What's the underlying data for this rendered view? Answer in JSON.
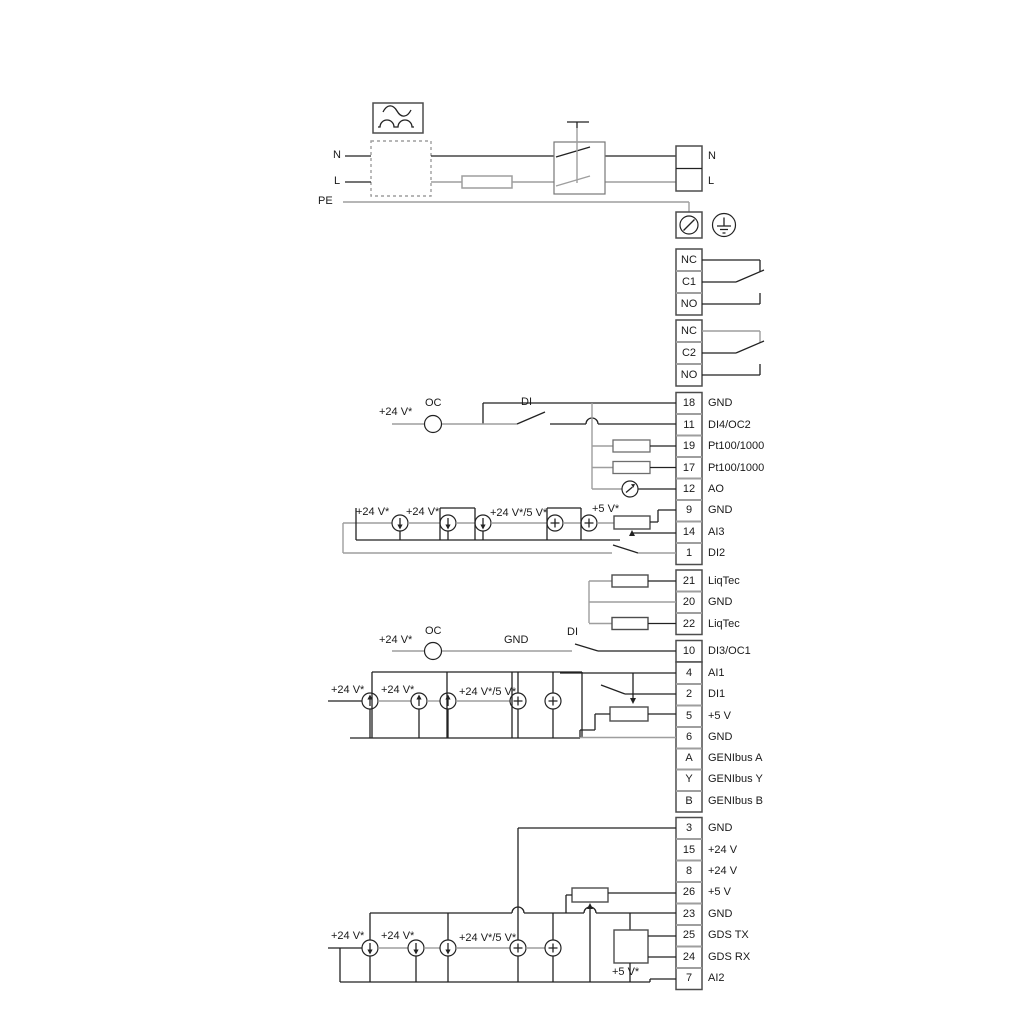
{
  "diagram_title": "pump-drive-wiring-diagram",
  "colors": {
    "wire_black": "#222222",
    "wire_gray": "#9e9e9e",
    "box_border": "#4d4d4d",
    "text": "#1a1a1a",
    "background": "#ffffff"
  },
  "power": {
    "left": {
      "n": "N",
      "l": "L",
      "pe": "PE"
    },
    "right": {
      "n": "N",
      "l": "L"
    }
  },
  "relays": [
    {
      "nc": "NC",
      "c": "C1",
      "no": "NO"
    },
    {
      "nc": "NC",
      "c": "C2",
      "no": "NO"
    }
  ],
  "annotations": {
    "oc_top": "OC",
    "di_top": "DI",
    "v24_top": "+24 V*",
    "ai3_v24a": "+24 V*",
    "ai3_v24b": "+24 V*",
    "ai3_v245": "+24 V*/5 V*",
    "ai3_v5": "+5 V*",
    "r10_v24": "+24 V*",
    "r10_oc": "OC",
    "r10_gnd": "GND",
    "r10_di": "DI",
    "ai1_v24a": "+24 V*",
    "ai1_v24b": "+24 V*",
    "ai1_v245": "+24 V*/5 V*",
    "ai2_v24a": "+24 V*",
    "ai2_v24b": "+24 V*",
    "ai2_v245": "+24 V*/5 V*",
    "gds_v5": "+5 V*"
  },
  "terminals": {
    "groupA": [
      {
        "id": "18",
        "label": "GND"
      },
      {
        "id": "11",
        "label": "DI4/OC2"
      },
      {
        "id": "19",
        "label": "Pt100/1000"
      },
      {
        "id": "17",
        "label": "Pt100/1000"
      },
      {
        "id": "12",
        "label": "AO"
      },
      {
        "id": "9",
        "label": "GND"
      },
      {
        "id": "14",
        "label": "AI3"
      },
      {
        "id": "1",
        "label": "DI2"
      }
    ],
    "groupB": [
      {
        "id": "21",
        "label": "LiqTec"
      },
      {
        "id": "20",
        "label": "GND"
      },
      {
        "id": "22",
        "label": "LiqTec"
      }
    ],
    "groupC": [
      {
        "id": "10",
        "label": "DI3/OC1"
      }
    ],
    "groupD": [
      {
        "id": "4",
        "label": "AI1"
      },
      {
        "id": "2",
        "label": "DI1"
      },
      {
        "id": "5",
        "label": "+5 V"
      },
      {
        "id": "6",
        "label": "GND"
      },
      {
        "id": "A",
        "label": "GENIbus A"
      },
      {
        "id": "Y",
        "label": "GENIbus Y"
      },
      {
        "id": "B",
        "label": "GENIbus B"
      }
    ],
    "groupE": [
      {
        "id": "3",
        "label": "GND"
      },
      {
        "id": "15",
        "label": "+24 V"
      },
      {
        "id": "8",
        "label": "+24 V"
      },
      {
        "id": "26",
        "label": "+5 V"
      },
      {
        "id": "23",
        "label": "GND"
      },
      {
        "id": "25",
        "label": "GDS TX"
      },
      {
        "id": "24",
        "label": "GDS RX"
      },
      {
        "id": "7",
        "label": "AI2"
      }
    ]
  }
}
